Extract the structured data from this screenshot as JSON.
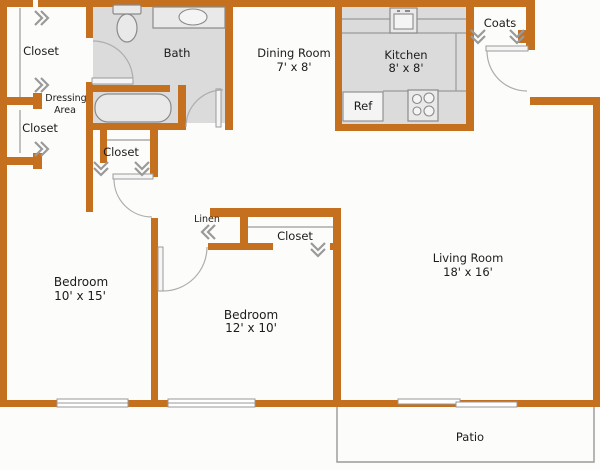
{
  "plan": {
    "labels": {
      "closet_top_left": "Closet",
      "dressing_line1": "Dressing",
      "dressing_line2": "Area",
      "closet_left": "Closet",
      "bath": "Bath",
      "dining_name": "Dining Room",
      "dining_dims": "7' x 8'",
      "kitchen_name": "Kitchen",
      "kitchen_dims": "8' x 8'",
      "ref": "Ref",
      "coats": "Coats",
      "closet_hall": "Closet",
      "linen": "Linen",
      "closet_bedroom2": "Closet",
      "bedroom1_name": "Bedroom",
      "bedroom1_dims": "10' x 15'",
      "bedroom2_name": "Bedroom",
      "bedroom2_dims": "12' x 10'",
      "living_name": "Living Room",
      "living_dims": "18' x 16'",
      "patio": "Patio"
    },
    "colors": {
      "wall": "#C4701E",
      "room_fill": "#DBDBDB",
      "line": "#9A9A9A",
      "text": "#1C1C1C",
      "background": "#FCFCFA"
    }
  }
}
